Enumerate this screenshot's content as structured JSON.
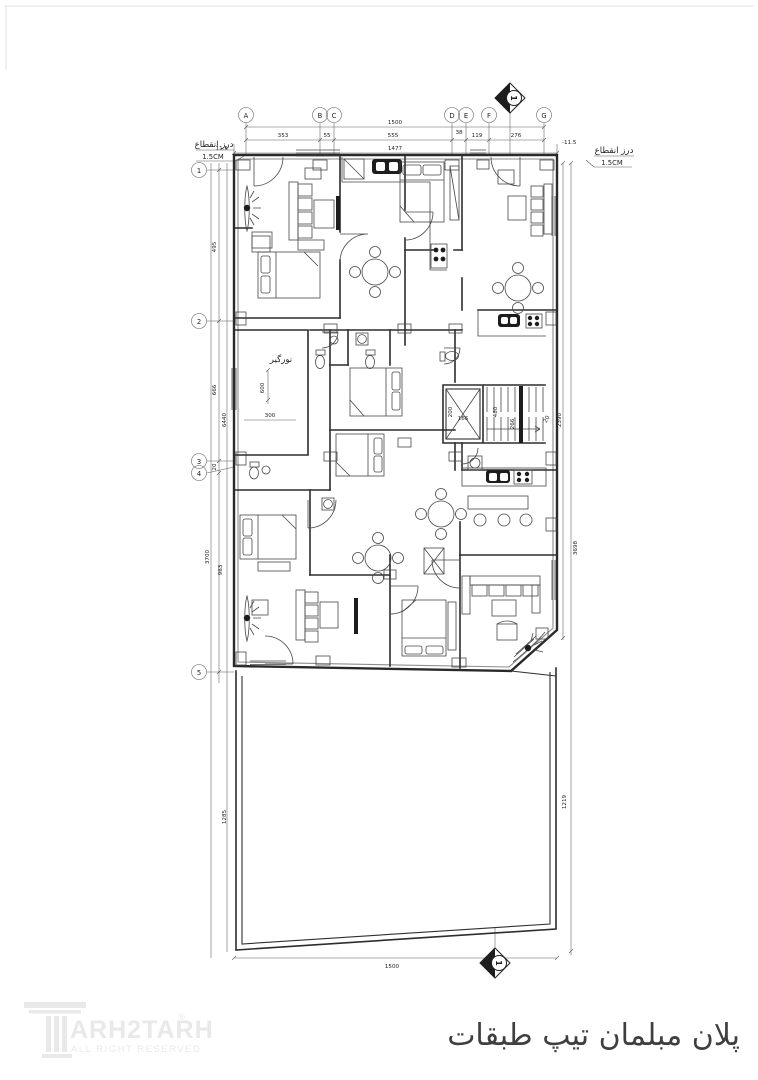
{
  "page": {
    "background": "#ffffff",
    "ink": "#2a2a2a",
    "watermark": "#e9e9e9"
  },
  "title": {
    "fa": "پلان مبلمان تیپ طبقات"
  },
  "logo": {
    "text": "ARH2TARH",
    "reg": "®",
    "tagline": "ALL RIGHT RESERVED"
  },
  "grid": {
    "cols": [
      "A",
      "B",
      "C",
      "D",
      "E",
      "F",
      "G"
    ],
    "rows": [
      "1",
      "2",
      "3",
      "4",
      "5"
    ]
  },
  "annotations": {
    "joint_label": "درز انقطاع",
    "joint_value": "1.5CM",
    "lightwell": "نورگیر",
    "section_no": "1"
  },
  "dims": {
    "top_overall": "1500",
    "top_segments": [
      "353",
      "55",
      "555",
      "38",
      "119",
      "276"
    ],
    "top_inner": "1477",
    "joint_left": "11.5",
    "joint_right": "-11.5",
    "left_segments": [
      "495",
      "666",
      "20",
      "963"
    ],
    "left_total": "6440",
    "left_outer": "3700",
    "left_yard": "1285",
    "right_upper": "2390",
    "right_overall": "3698",
    "right_yard": "1219",
    "bottom_overall": "1500",
    "lightwell_h": "600",
    "lightwell_w": "300",
    "elevator_h": "200",
    "elevator_w": "166",
    "stair_run": "480",
    "stair_width": "266",
    "stair_gap": "20"
  }
}
